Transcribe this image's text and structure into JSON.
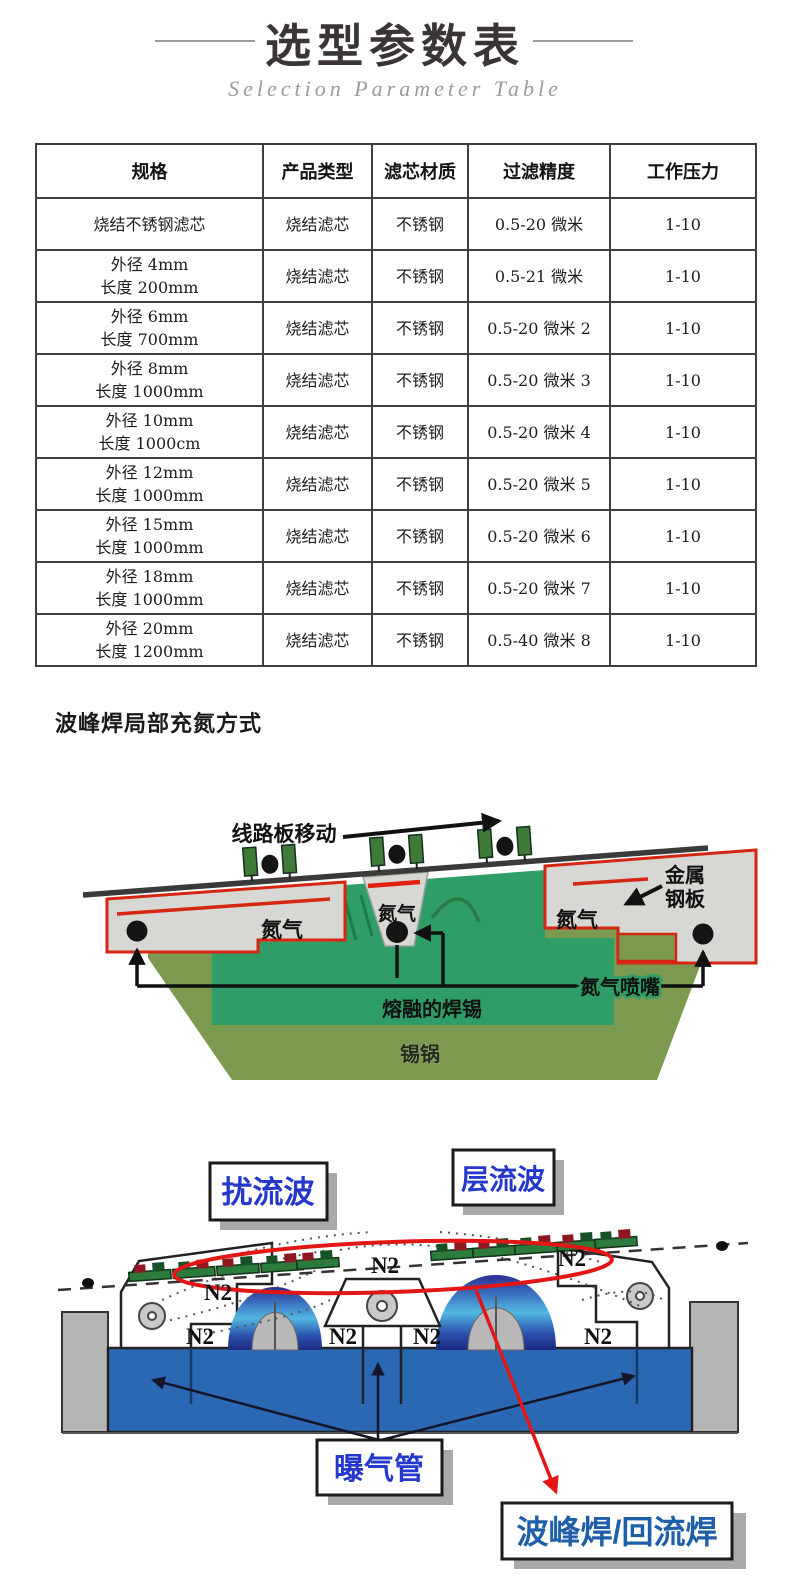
{
  "header": {
    "title": "选型参数表",
    "subtitle": "Selection Parameter Table"
  },
  "table": {
    "headers": [
      "规格",
      "产品类型",
      "滤芯材质",
      "过滤精度",
      "工作压力"
    ],
    "rows": [
      {
        "spec1": "烧结不锈钢滤芯",
        "spec2": "",
        "type": "烧结滤芯",
        "material": "不锈钢",
        "precision": "0.5-20 微米",
        "pressure": "1-10"
      },
      {
        "spec1": "外径 4mm",
        "spec2": "长度 200mm",
        "type": "烧结滤芯",
        "material": "不锈钢",
        "precision": "0.5-21 微米",
        "pressure": "1-10"
      },
      {
        "spec1": "外径 6mm",
        "spec2": "长度 700mm",
        "type": "烧结滤芯",
        "material": "不锈钢",
        "precision": "0.5-20 微米 2",
        "pressure": "1-10"
      },
      {
        "spec1": "外径 8mm",
        "spec2": "长度 1000mm",
        "type": "烧结滤芯",
        "material": "不锈钢",
        "precision": "0.5-20 微米 3",
        "pressure": "1-10"
      },
      {
        "spec1": "外径 10mm",
        "spec2": "长度 1000cm",
        "type": "烧结滤芯",
        "material": "不锈钢",
        "precision": "0.5-20 微米 4",
        "pressure": "1-10"
      },
      {
        "spec1": "外径 12mm",
        "spec2": "长度 1000mm",
        "type": "烧结滤芯",
        "material": "不锈钢",
        "precision": "0.5-20 微米 5",
        "pressure": "1-10"
      },
      {
        "spec1": "外径 15mm",
        "spec2": "长度 1000mm",
        "type": "烧结滤芯",
        "material": "不锈钢",
        "precision": "0.5-20 微米 6",
        "pressure": "1-10"
      },
      {
        "spec1": "外径 18mm",
        "spec2": "长度 1000mm",
        "type": "烧结滤芯",
        "material": "不锈钢",
        "precision": "0.5-20 微米 7",
        "pressure": "1-10"
      },
      {
        "spec1": "外径 20mm",
        "spec2": "长度 1200mm",
        "type": "烧结滤芯",
        "material": "不锈钢",
        "precision": "0.5-40 微米 8",
        "pressure": "1-10"
      }
    ]
  },
  "section": {
    "heading": "波峰焊局部充氮方式"
  },
  "diagram1": {
    "labels": {
      "board_move": "线路板移动",
      "metal_plate_line1": "金属",
      "metal_plate_line2": "钢板",
      "nitrogen_left": "氮气",
      "nitrogen_center": "氮气",
      "nitrogen_right": "氮气",
      "nozzle": "氮气喷嘴",
      "molten_solder": "熔融的焊锡",
      "tin_pot": "锡锅"
    }
  },
  "diagram2": {
    "labels": {
      "turbulent_wave": "扰流波",
      "laminar_wave": "层流波",
      "aeration_pipe": "曝气管",
      "wave_reflow": "波峰焊/回流焊"
    },
    "n2": [
      "N2",
      "N2",
      "N2",
      "N2",
      "N2",
      "N2",
      "N2"
    ]
  },
  "colors": {
    "title_text": "#3a3534",
    "subtitle_text": "#9c9c9c",
    "table_border": "#3f3f3f",
    "chamber_gray": "#d7d8d3",
    "chamber_red_outline": "#d42613",
    "molten_solder_teal": "#2f9e66",
    "pot_olive": "#7b9a50",
    "tank_blue": "#2a68b4",
    "pillar_gray": "#b5b5b5",
    "box_shadow_gray": "#a9a9a9",
    "box_text_blue": "#2438cc",
    "wave_reflow_text_blue": "#1e5fa8",
    "red_ellipse": "#e31616"
  }
}
